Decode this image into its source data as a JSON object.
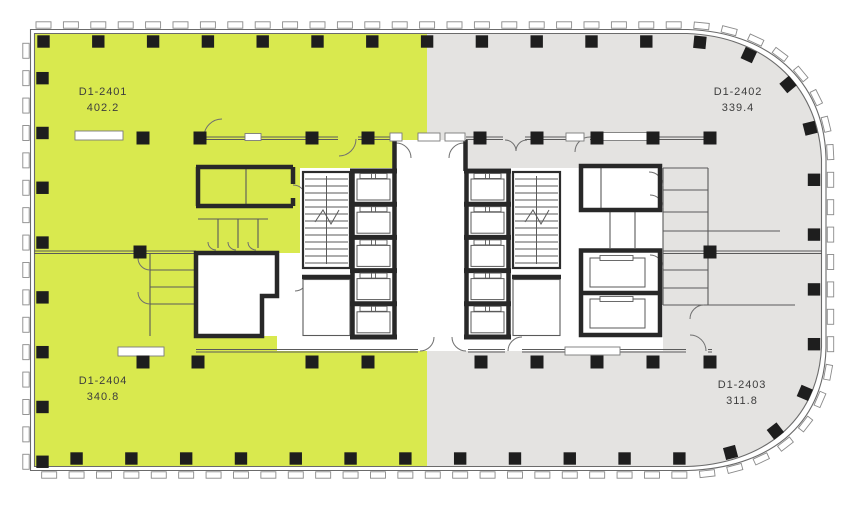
{
  "floor_plan": {
    "title": "Floor plate with four units",
    "units": [
      {
        "id": "D1-2401",
        "area": "402.2",
        "fill": "#d9e94e",
        "highlighted": true,
        "position": "top-left"
      },
      {
        "id": "D1-2402",
        "area": "339.4",
        "fill": "#e4e3e1",
        "highlighted": false,
        "position": "top-right"
      },
      {
        "id": "D1-2403",
        "area": "311.8",
        "fill": "#e4e3e1",
        "highlighted": false,
        "position": "bottom-right"
      },
      {
        "id": "D1-2404",
        "area": "340.8",
        "fill": "#d9e94e",
        "highlighted": true,
        "position": "bottom-left"
      }
    ],
    "colors": {
      "highlight": "#d9e94e",
      "standard": "#e4e3e1",
      "wall": "#282828",
      "thin_line": "#5a5a5a",
      "column": "#1e1e1e"
    }
  }
}
